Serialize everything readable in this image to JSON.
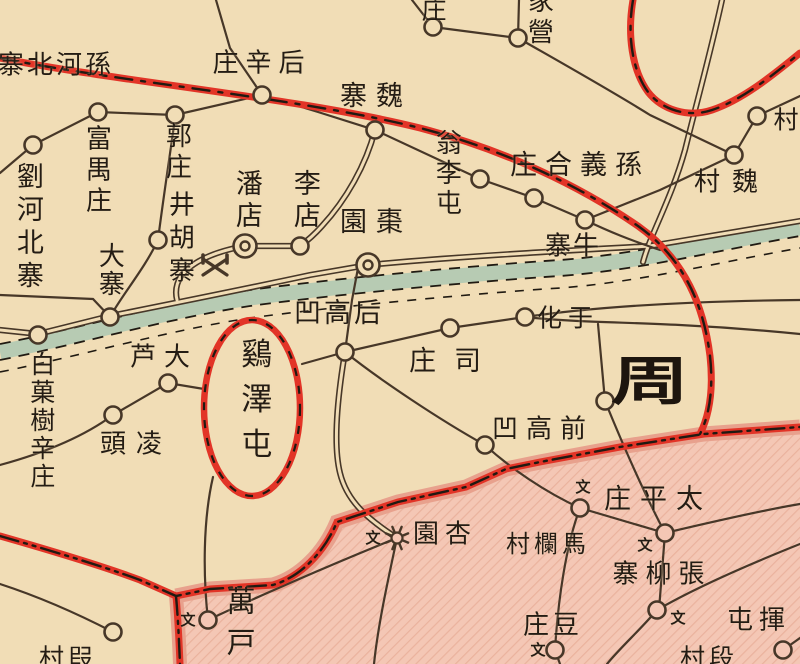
{
  "map": {
    "colors": {
      "paper": "#f1ddb6",
      "river_fill": "#b7cbb3",
      "boundary_red": "#e23427",
      "boundary_black": "#201a12",
      "road_black": "#473728",
      "label_ink": "#241c14",
      "pink_base": "#f4c7b5",
      "pink_hatch": "#eab29d",
      "pink_band": "#e8a18d"
    },
    "region_label": {
      "id": "zhou-region",
      "text": "周",
      "x": 650,
      "y": 377,
      "font_size": 52
    },
    "labels": [
      {
        "id": "sun-he-bei-zhai",
        "text": "寨北河孫",
        "dir": "h",
        "x": 56,
        "y": 66,
        "fs": 26,
        "ls": 3
      },
      {
        "id": "hou-xin-zhuang",
        "text": "庄辛后",
        "dir": "h",
        "x": 262,
        "y": 64,
        "fs": 26,
        "ls": 7
      },
      {
        "id": "wei-zhai",
        "text": "寨魏",
        "dir": "h",
        "x": 376,
        "y": 97,
        "fs": 27,
        "ls": 9
      },
      {
        "id": "zhuang-top-partial",
        "text": "庄",
        "dir": "h",
        "x": 434,
        "y": 10,
        "fs": 25,
        "ls": 0
      },
      {
        "id": "jia-ying",
        "text": "家營",
        "dir": "v",
        "x": 538,
        "y": 18,
        "fs": 26,
        "ls": 5
      },
      {
        "id": "liu-he-bei-zhai",
        "text": "劉河北寨",
        "dir": "v",
        "x": 27,
        "y": 228,
        "fs": 27,
        "ls": 6
      },
      {
        "id": "fu-yu-zhuang",
        "text": "富禺庄",
        "dir": "v",
        "x": 96,
        "y": 171,
        "fs": 26,
        "ls": 5
      },
      {
        "id": "guo-zhuang",
        "text": "郭庄",
        "dir": "v",
        "x": 176,
        "y": 153,
        "fs": 26,
        "ls": 5
      },
      {
        "id": "jing-hu-zhai",
        "text": "井胡寨",
        "dir": "v",
        "x": 179,
        "y": 240,
        "fs": 26,
        "ls": 7
      },
      {
        "id": "da-zhai",
        "text": "大寨",
        "dir": "v",
        "x": 109,
        "y": 270,
        "fs": 26,
        "ls": 2
      },
      {
        "id": "pan-dian",
        "text": "潘店",
        "dir": "v",
        "x": 246,
        "y": 201,
        "fs": 27,
        "ls": 5
      },
      {
        "id": "li-dian",
        "text": "李店",
        "dir": "v",
        "x": 304,
        "y": 201,
        "fs": 27,
        "ls": 5
      },
      {
        "id": "zao-yuan",
        "text": "園棗",
        "dir": "h",
        "x": 376,
        "y": 223,
        "fs": 27,
        "ls": 9
      },
      {
        "id": "weng-li-tun",
        "text": "翁李屯",
        "dir": "v",
        "x": 446,
        "y": 174,
        "fs": 26,
        "ls": 4
      },
      {
        "id": "sun-yi-he-zhuang",
        "text": "庄合義孫",
        "dir": "h",
        "x": 580,
        "y": 166,
        "fs": 27,
        "ls": 8
      },
      {
        "id": "niu-zhai",
        "text": "寨牛",
        "dir": "h",
        "x": 573,
        "y": 247,
        "fs": 26,
        "ls": 2
      },
      {
        "id": "cun-top-right-partial",
        "text": "村",
        "dir": "h",
        "x": 786,
        "y": 120,
        "fs": 25,
        "ls": 0
      },
      {
        "id": "wei-cun",
        "text": "村魏",
        "dir": "h",
        "x": 732,
        "y": 183,
        "fs": 26,
        "ls": 12
      },
      {
        "id": "yu-hua",
        "text": "化于",
        "dir": "h",
        "x": 568,
        "y": 318,
        "fs": 25,
        "ls": 6
      },
      {
        "id": "si-zhuang",
        "text": "庄司",
        "dir": "h",
        "x": 454,
        "y": 362,
        "fs": 27,
        "ls": 18
      },
      {
        "id": "hou-gao-ao",
        "text": "凹高后",
        "dir": "h",
        "x": 339,
        "y": 314,
        "fs": 27,
        "ls": 3
      },
      {
        "id": "qian-gao-ao",
        "text": "凹高前",
        "dir": "h",
        "x": 543,
        "y": 430,
        "fs": 26,
        "ls": 8
      },
      {
        "id": "da-lu",
        "text": "芦大",
        "dir": "h",
        "x": 164,
        "y": 358,
        "fs": 26,
        "ls": 8
      },
      {
        "id": "ling-tou",
        "text": "頭凌",
        "dir": "h",
        "x": 136,
        "y": 445,
        "fs": 26,
        "ls": 10
      },
      {
        "id": "bai-guo-shu-xin-zhuang",
        "text": "白菓樹辛庄",
        "dir": "v",
        "x": 41,
        "y": 421,
        "fs": 25,
        "ls": 3
      },
      {
        "id": "ji-ze-tun",
        "text": "鷄澤屯",
        "dir": "v",
        "x": 253,
        "y": 405,
        "fs": 31,
        "ls": 14
      },
      {
        "id": "tai-ping-zhuang",
        "text": "庄平太",
        "dir": "h",
        "x": 658,
        "y": 500,
        "fs": 27,
        "ls": 9
      },
      {
        "id": "ma-lan-cun",
        "text": "村欄馬",
        "dir": "h",
        "x": 548,
        "y": 544,
        "fs": 24,
        "ls": 4
      },
      {
        "id": "zhang-liu-zhai",
        "text": "寨柳張",
        "dir": "h",
        "x": 662,
        "y": 575,
        "fs": 26,
        "ls": 7
      },
      {
        "id": "dou-zhuang",
        "text": "庄豆",
        "dir": "h",
        "x": 553,
        "y": 626,
        "fs": 26,
        "ls": 4
      },
      {
        "id": "xing-yuan",
        "text": "園杏",
        "dir": "h",
        "x": 445,
        "y": 535,
        "fs": 26,
        "ls": 6
      },
      {
        "id": "wan-hu",
        "text": "萬戸",
        "dir": "v",
        "x": 239,
        "y": 627,
        "fs": 29,
        "ls": 12
      },
      {
        "id": "hui-tun",
        "text": "屯揮",
        "dir": "h",
        "x": 759,
        "y": 621,
        "fs": 26,
        "ls": 6
      },
      {
        "id": "duan-cun-bottom-right",
        "text": "村段",
        "dir": "h",
        "x": 709,
        "y": 658,
        "fs": 25,
        "ls": 4
      },
      {
        "id": "duan-cun-bottom-left",
        "text": "村叚",
        "dir": "h",
        "x": 68,
        "y": 658,
        "fs": 25,
        "ls": 4
      }
    ],
    "school_symbols": [
      {
        "glyph": "文",
        "x": 373,
        "y": 539
      },
      {
        "glyph": "文",
        "x": 188,
        "y": 621
      },
      {
        "glyph": "文",
        "x": 538,
        "y": 651
      },
      {
        "glyph": "文",
        "x": 583,
        "y": 488
      },
      {
        "glyph": "文",
        "x": 645,
        "y": 546
      },
      {
        "glyph": "文",
        "x": 678,
        "y": 619
      }
    ],
    "settlements": [
      {
        "id": "settlement-1",
        "type": "circle",
        "x": 33,
        "y": 145,
        "area": "cream"
      },
      {
        "id": "settlement-2",
        "type": "circle",
        "x": 98,
        "y": 112,
        "area": "cream"
      },
      {
        "id": "settlement-3",
        "type": "circle",
        "x": 175,
        "y": 115,
        "area": "cream"
      },
      {
        "id": "hou-xin-zhuang",
        "type": "circle",
        "x": 262,
        "y": 95,
        "area": "cream"
      },
      {
        "id": "wei-zhai",
        "type": "circle",
        "x": 375,
        "y": 130,
        "area": "cream"
      },
      {
        "id": "settlement-4",
        "type": "circle",
        "x": 433,
        "y": 27,
        "area": "cream"
      },
      {
        "id": "jia-ying",
        "type": "circle",
        "x": 518,
        "y": 38,
        "area": "cream"
      },
      {
        "id": "cun-top-right",
        "type": "circle",
        "x": 757,
        "y": 116,
        "area": "cream"
      },
      {
        "id": "wei-cun",
        "type": "circle",
        "x": 734,
        "y": 155,
        "area": "cream"
      },
      {
        "id": "weng-li-tun",
        "type": "circle",
        "x": 480,
        "y": 179,
        "area": "cream"
      },
      {
        "id": "settlement-5",
        "type": "circle",
        "x": 534,
        "y": 198,
        "area": "cream"
      },
      {
        "id": "niu-zhai",
        "type": "circle",
        "x": 585,
        "y": 220,
        "area": "cream"
      },
      {
        "id": "jing-hu-zhai",
        "type": "circle",
        "x": 158,
        "y": 240,
        "area": "cream"
      },
      {
        "id": "li-dian",
        "type": "circle",
        "x": 300,
        "y": 246,
        "area": "cream"
      },
      {
        "id": "da-zhai",
        "type": "circle",
        "x": 110,
        "y": 317,
        "area": "cream"
      },
      {
        "id": "bai-guo-shu",
        "type": "circle",
        "x": 38,
        "y": 335,
        "area": "cream"
      },
      {
        "id": "da-lu",
        "type": "circle",
        "x": 168,
        "y": 383,
        "area": "cream"
      },
      {
        "id": "ling-tou",
        "type": "circle",
        "x": 113,
        "y": 415,
        "area": "cream"
      },
      {
        "id": "hou-gao-ao",
        "type": "circle",
        "x": 345,
        "y": 352,
        "area": "cream"
      },
      {
        "id": "si-zhuang",
        "type": "circle",
        "x": 450,
        "y": 328,
        "area": "cream"
      },
      {
        "id": "yu-hua",
        "type": "circle",
        "x": 525,
        "y": 317,
        "area": "cream"
      },
      {
        "id": "qian-gao-ao",
        "type": "circle",
        "x": 485,
        "y": 445,
        "area": "cream"
      },
      {
        "id": "settlement-6",
        "type": "circle",
        "x": 605,
        "y": 401,
        "area": "cream"
      },
      {
        "id": "settlement-7",
        "type": "circle",
        "x": 113,
        "y": 632,
        "area": "cream"
      },
      {
        "id": "settlement-8",
        "type": "circle",
        "x": 580,
        "y": 508,
        "area": "pink"
      },
      {
        "id": "tai-ping-zhuang",
        "type": "circle",
        "x": 665,
        "y": 533,
        "area": "pink"
      },
      {
        "id": "zhang-liu-zhai",
        "type": "circle",
        "x": 657,
        "y": 610,
        "area": "pink"
      },
      {
        "id": "dou-zhuang",
        "type": "circle",
        "x": 555,
        "y": 650,
        "area": "pink"
      },
      {
        "id": "wan-hu",
        "type": "circle",
        "x": 208,
        "y": 620,
        "area": "pink"
      },
      {
        "id": "settlement-9",
        "type": "circle",
        "x": 783,
        "y": 650,
        "area": "pink"
      },
      {
        "id": "pan-dian",
        "type": "double-circle",
        "x": 245,
        "y": 246,
        "area": "cream"
      },
      {
        "id": "zao-yuan",
        "type": "double-circle",
        "x": 368,
        "y": 265,
        "area": "cream"
      },
      {
        "id": "xing-yuan",
        "type": "star",
        "x": 397,
        "y": 538,
        "area": "pink"
      },
      {
        "id": "mine-symbol",
        "type": "mine",
        "x": 215,
        "y": 267,
        "area": "cream"
      }
    ]
  }
}
